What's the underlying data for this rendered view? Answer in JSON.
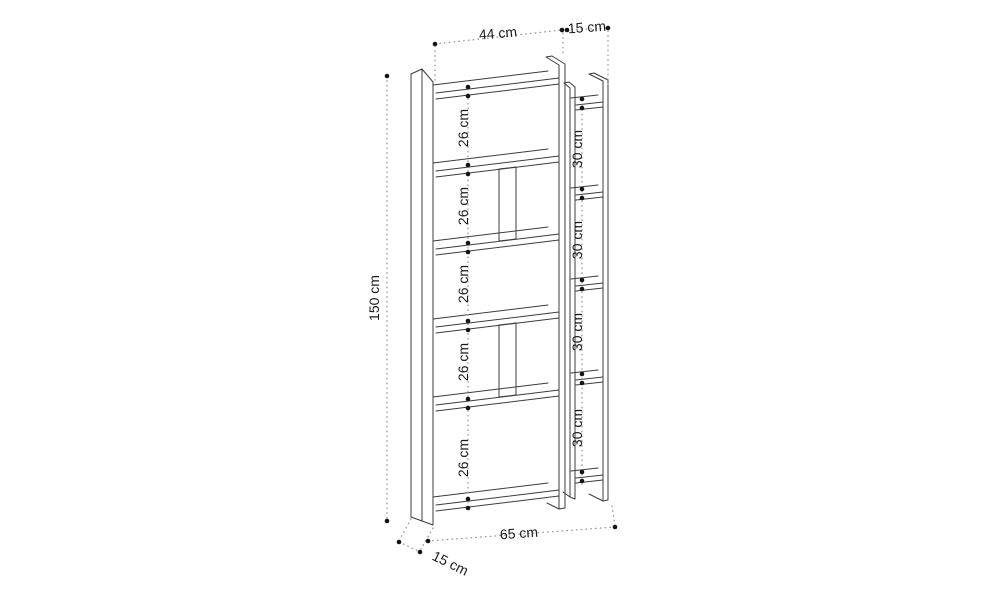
{
  "diagram": {
    "unit": "cm",
    "dimensions": {
      "main_width_top": "44 cm",
      "side_width_top": "15 cm",
      "height_left": "150 cm",
      "total_width_bottom": "65 cm",
      "depth_bottom": "15 cm",
      "main_shelf_gaps": [
        "26 cm",
        "26 cm",
        "26 cm",
        "26 cm",
        "26 cm"
      ],
      "side_shelf_gaps": [
        "30 cm",
        "30 cm",
        "30 cm",
        "30 cm"
      ]
    },
    "colors": {
      "line": "#3c3c3c",
      "label": "#1a1a1a",
      "dot": "#141414",
      "guide": "#9a9a9a",
      "background": "#ffffff"
    }
  }
}
